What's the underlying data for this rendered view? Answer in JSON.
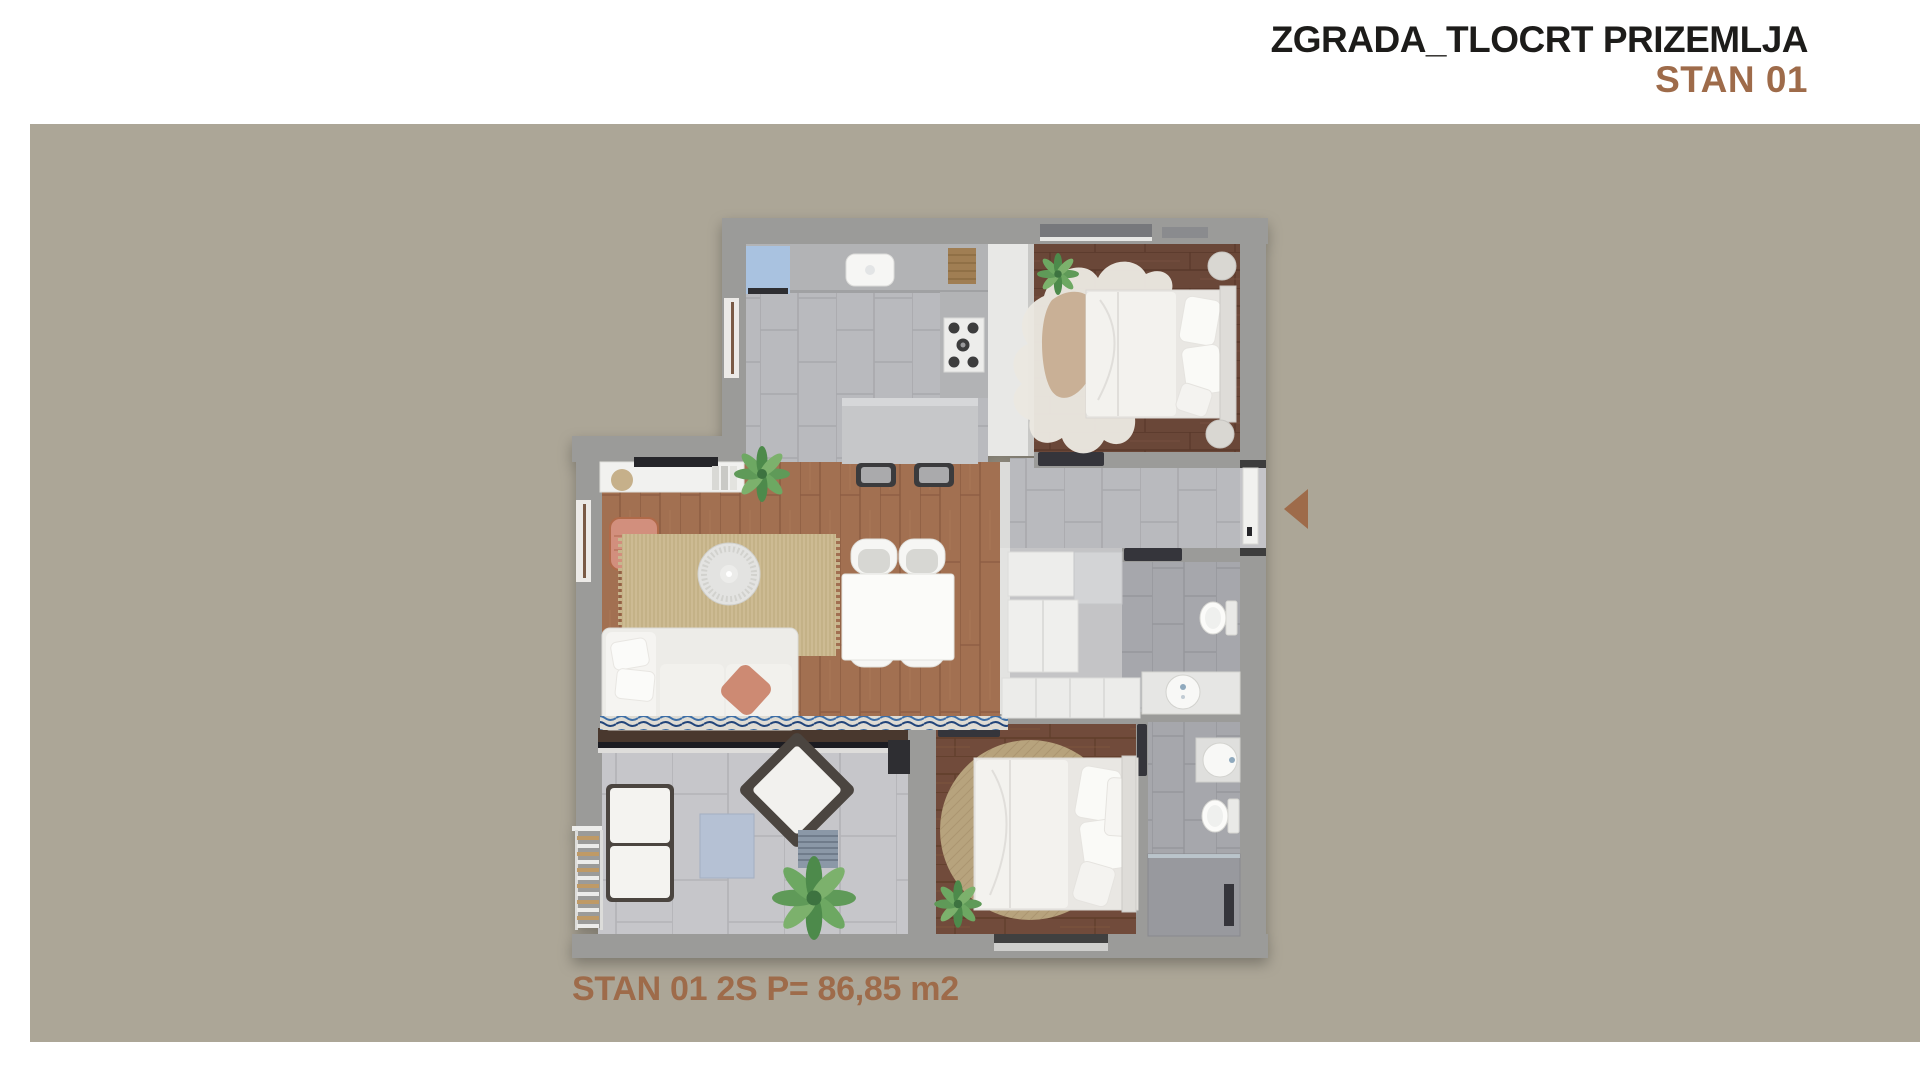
{
  "header": {
    "title": "ZGRADA_TLOCRT PRIZEMLJA",
    "apartment": "STAN 01"
  },
  "footer": {
    "area_label": "STAN 01 2S P= 86,85 m2"
  },
  "colors": {
    "accent": "#9e6b4a",
    "canvas": "#aca697",
    "title": "#1d1c1a"
  },
  "icons": {
    "entrance_arrow": "triangle-left"
  }
}
